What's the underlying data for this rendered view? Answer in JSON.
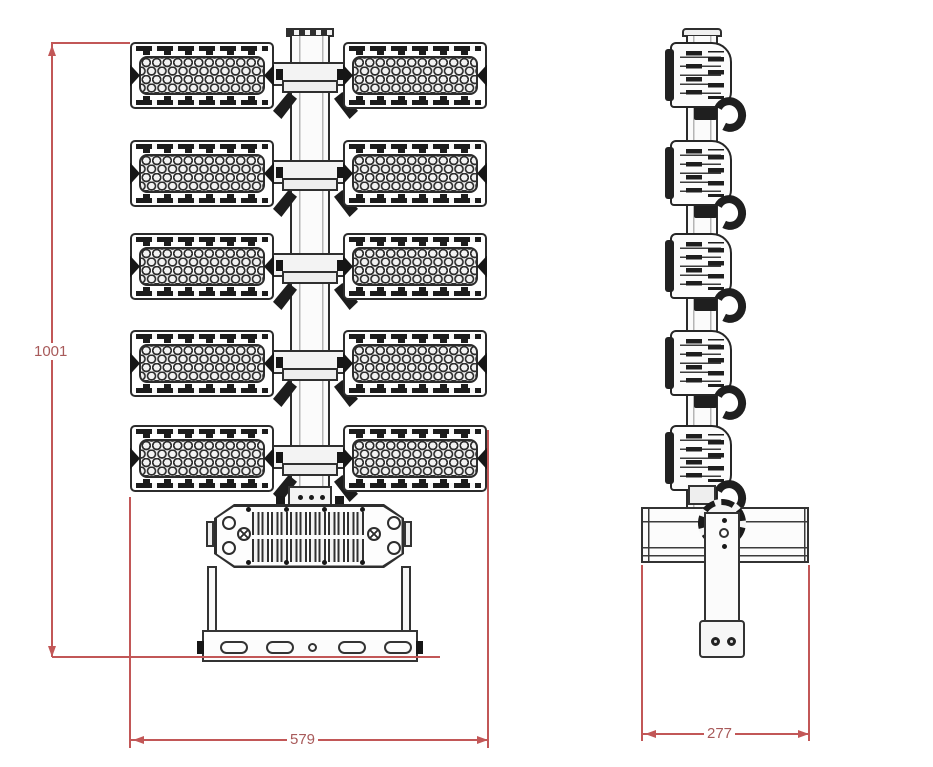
{
  "drawing": {
    "dimensions": {
      "overall_height": "1001",
      "front_width": "579",
      "side_depth": "277"
    },
    "front_view": {
      "module_rows": 5,
      "modules_per_row": 2
    },
    "side_view": {
      "module_count": 5
    },
    "colors": {
      "line": "#2c2c2c",
      "dimension_line": "#c25757",
      "dimension_text": "#a85a5a",
      "background": "#ffffff"
    }
  }
}
